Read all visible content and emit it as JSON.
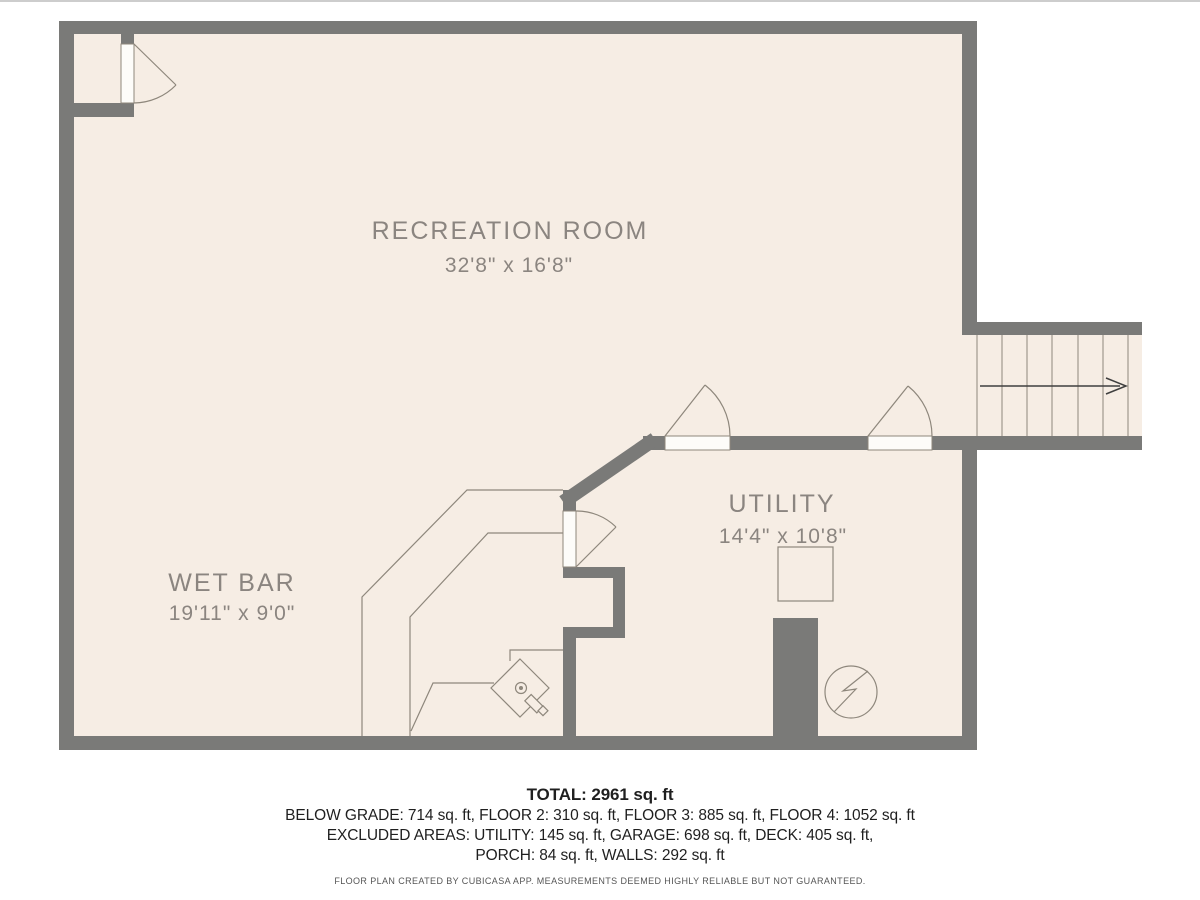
{
  "rooms": [
    {
      "name": "RECREATION ROOM",
      "dims": "32'8\" x 16'8\""
    },
    {
      "name": "WET BAR",
      "dims": "19'11\" x 9'0\""
    },
    {
      "name": "UTILITY",
      "dims": "14'4\" x 10'8\""
    }
  ],
  "summary": {
    "total": "TOTAL: 2961 sq. ft",
    "line1": "BELOW GRADE: 714 sq. ft, FLOOR 2: 310 sq. ft, FLOOR 3: 885 sq. ft, FLOOR 4: 1052 sq. ft",
    "line2": "EXCLUDED AREAS: UTILITY: 145 sq. ft, GARAGE: 698 sq. ft, DECK: 405 sq. ft,",
    "line3": "PORCH: 84 sq. ft, WALLS: 292 sq. ft"
  },
  "disclaimer": "FLOOR PLAN CREATED BY CUBICASA APP. MEASUREMENTS DEEMED HIGHLY RELIABLE BUT NOT GUARANTEED.",
  "colors": {
    "floor": "#f6ede4",
    "wall": "#7a7a78",
    "thin_line": "#8e877c",
    "label_text": "#8b8580",
    "summary_text": "#1f1f1f"
  }
}
